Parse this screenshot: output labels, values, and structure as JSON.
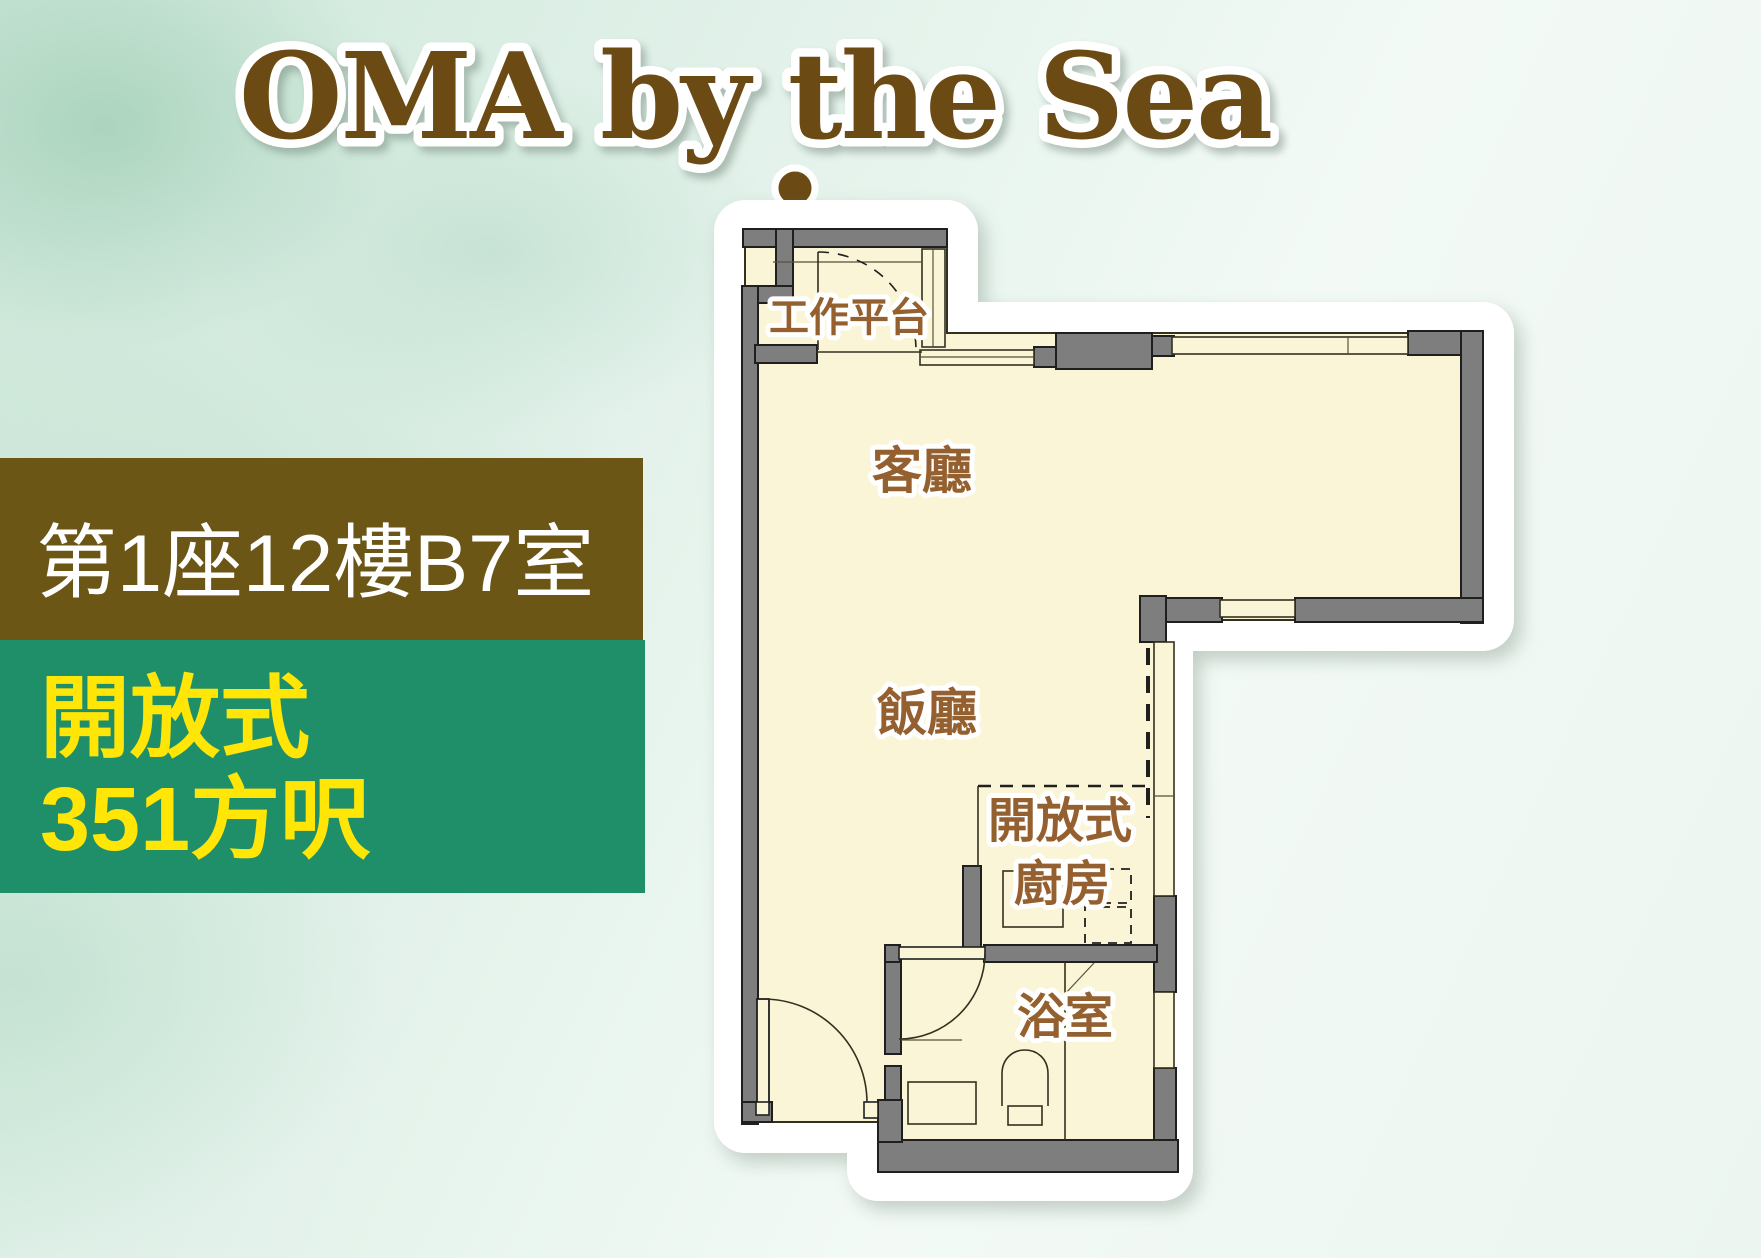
{
  "title": "OMA by the Sea",
  "unit_bar": {
    "label": "第1座12樓B7室"
  },
  "spec_bar": {
    "line1": "開放式",
    "line2": "351方呎"
  },
  "floor_plan": {
    "rooms": {
      "work_platform": "工作平台",
      "living_room": "客廳",
      "dining_room": "飯廳",
      "open_kitchen_line1": "開放式",
      "open_kitchen_line2": "廚房",
      "bathroom": "浴室"
    }
  },
  "colors": {
    "title_brown": "#6B4A14",
    "unit_bar_bg": "#6B5616",
    "unit_bar_text": "#FFFFFF",
    "spec_bar_bg": "#1F8F69",
    "spec_bar_text": "#FFE607",
    "floor_fill": "#FAF5D6",
    "wall_gray": "#7E7E7E",
    "room_label_brown": "#95602F"
  }
}
